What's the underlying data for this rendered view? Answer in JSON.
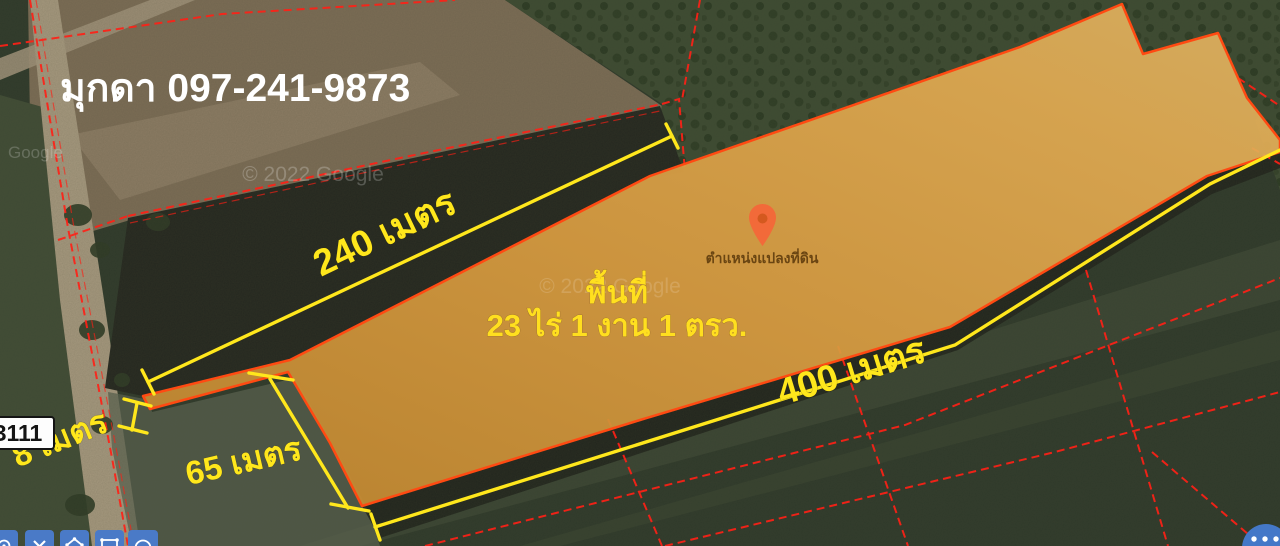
{
  "listing": {
    "contact_name_phone": "มุกดา 097-241-9873",
    "area_title": "พื้นที่",
    "area_value": "23 ไร่ 1 งาน 1 ตรว.",
    "pin_label": "ตำแหน่งแปลงที่ดิน"
  },
  "measurements": {
    "top_edge": "240 เมตร",
    "bottom_edge": "400 เมตร",
    "left_edge": "65 เมตร",
    "road_frontage": "8 เมตร"
  },
  "map": {
    "route_sign": "3111",
    "attribution": "© 2022 Google",
    "attribution_secondary": "© 2022 Google",
    "attribution_partial": "Google"
  },
  "toolbar": {
    "tools": [
      {
        "icon": "point-tool-icon"
      },
      {
        "icon": "close-icon"
      },
      {
        "icon": "polygon-tool-icon"
      },
      {
        "icon": "rectangle-tool-icon"
      },
      {
        "icon": "circle-tool-icon"
      }
    ],
    "more_icon": "more-dots-icon"
  },
  "colors": {
    "plot_fill": "#d89b40",
    "plot_stroke": "#ff4a12",
    "boundary_red": "#ff2016",
    "measurement_yellow": "#ffe71c",
    "area_text_yellow": "#ffdf1f",
    "contact_text": "#ffffff",
    "pin_orange": "#f26a39",
    "tool_button_blue": "#4a7ac7"
  }
}
